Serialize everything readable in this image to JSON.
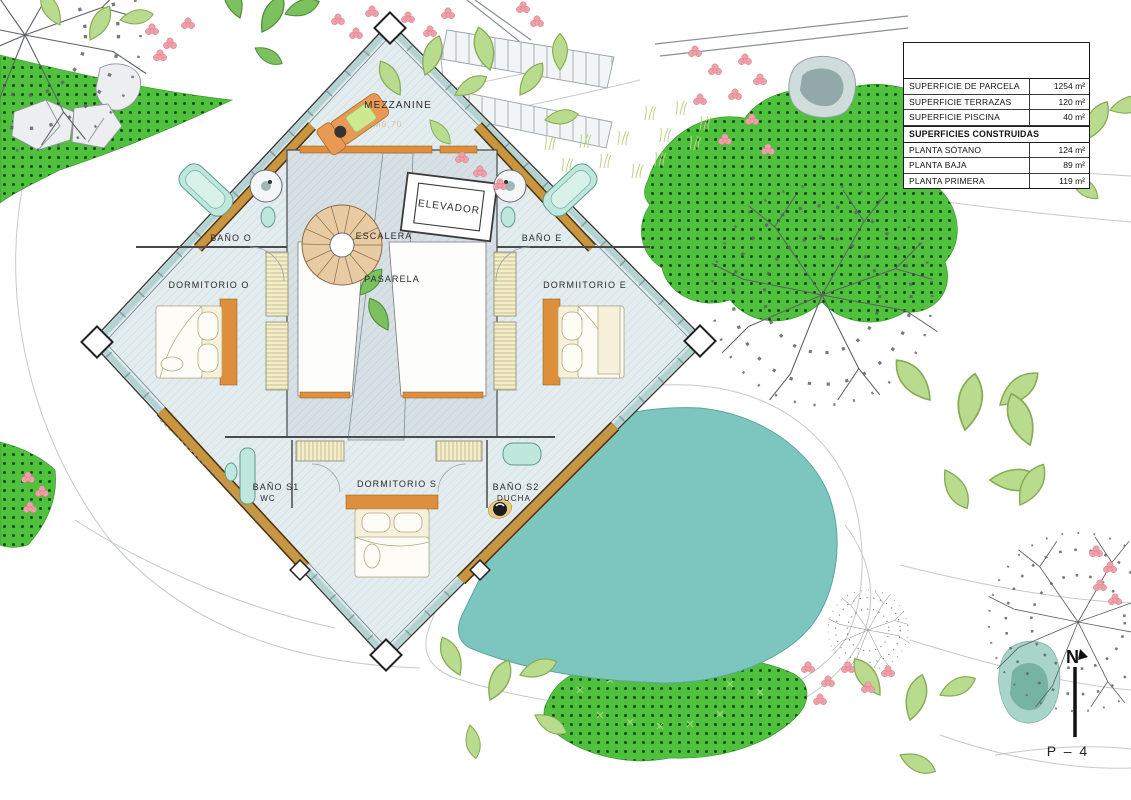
{
  "sheet": {
    "north_label": "N",
    "sheet_label": "P – 4"
  },
  "rooms": {
    "mezzanine": "MEZZANINE",
    "mezzanine_level": "+M6,70",
    "escalera": "ESCALERA",
    "elevador": "ELEVADOR",
    "pasarela": "PASARELA",
    "bano_o": "BAÑO O",
    "dormitorio_o": "DORMITORIO O",
    "bano_e": "BAÑO E",
    "dormitorio_e": "DORMIITORIO E",
    "bano_s1": "BAÑO S1",
    "bano_s1_sub": "WC",
    "dormitorio_s": "DORMITORIO S",
    "bano_s2": "BAÑO S2",
    "bano_s2_sub": "DUCHA"
  },
  "areas_table": {
    "section_header": "SUPERFICIES CONSTRUIDAS",
    "parcel_rows": [
      {
        "label": "SUPERFICIE DE PARCELA",
        "value": "1254 m²"
      },
      {
        "label": "SUPERFICIE TERRAZAS",
        "value": "120 m²"
      },
      {
        "label": "SUPERFICIE PISCINA",
        "value": "40 m²"
      }
    ],
    "built_rows": [
      {
        "label": "PLANTA SÓTANO",
        "value": "124 m²"
      },
      {
        "label": "PLANTA BAJA",
        "value": "89 m²"
      },
      {
        "label": "PLANTA PRIMERA",
        "value": "119 m²"
      }
    ]
  },
  "colors": {
    "pool": "#7dc6c0",
    "grass": "#4fc13c",
    "grass_dot": "#0e4d12",
    "wood": "#c9953f",
    "accent_orange": "#dd8f3c",
    "fixture_teal": "#bfe8dd",
    "floor": "#e3ecef",
    "wall_glass": "#b3d3d3"
  }
}
